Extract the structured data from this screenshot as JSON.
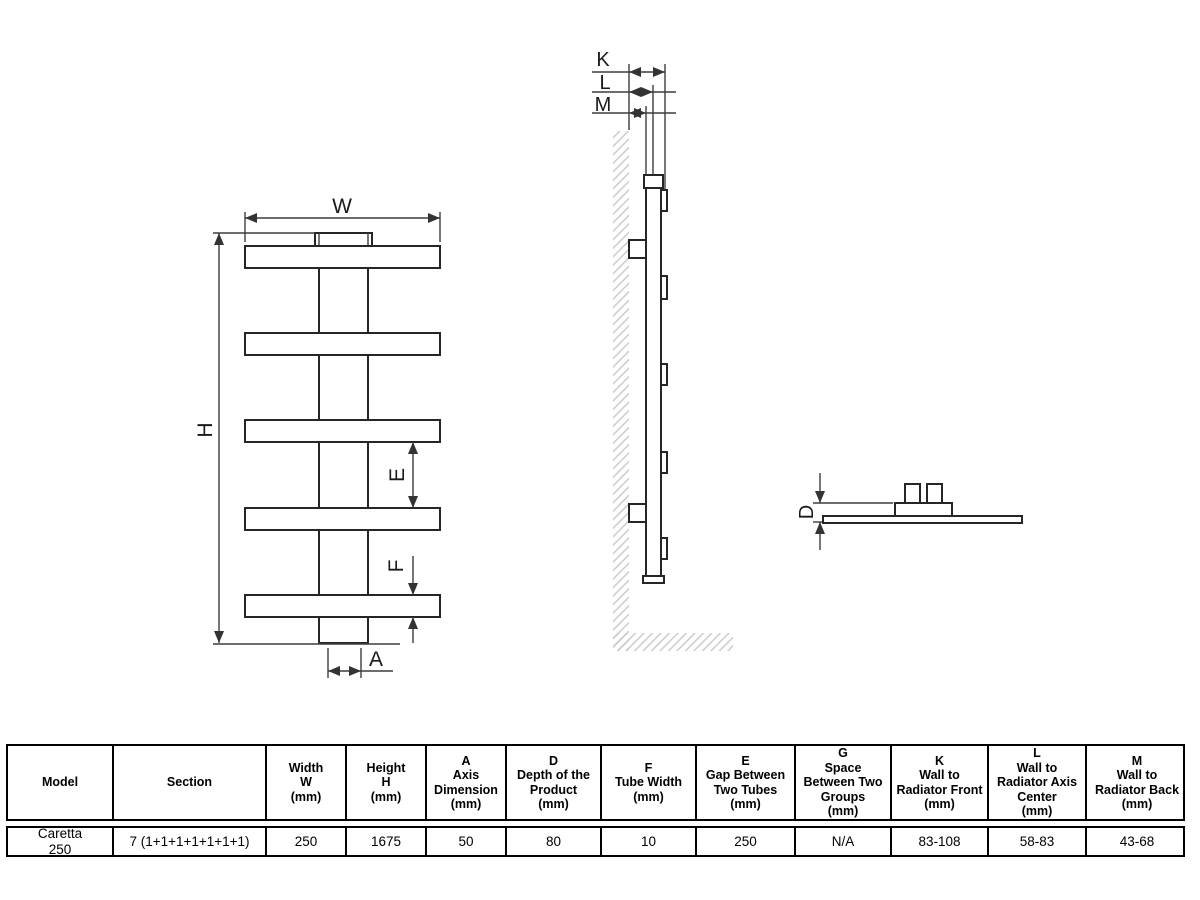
{
  "title": "Caretta 250 towel radiator dimension drawing",
  "colors": {
    "line": "#262626",
    "dimension_line": "#3d3d3d",
    "hatch": "#c8c8c8",
    "background": "#ffffff"
  },
  "dimensions": {
    "W": "W",
    "H": "H",
    "E": "E",
    "F": "F",
    "A": "A",
    "K": "K",
    "L": "L",
    "M": "M",
    "D": "D"
  },
  "table": {
    "headers": [
      "Model",
      "Section",
      "Width\nW\n(mm)",
      "Height\nH\n(mm)",
      "A\nAxis\nDimension\n(mm)",
      "D\nDepth of the\nProduct\n(mm)",
      "F\nTube Width\n(mm)",
      "E\nGap Between\nTwo Tubes\n(mm)",
      "G\nSpace\nBetween Two\nGroups\n(mm)",
      "K\nWall to\nRadiator Front\n(mm)",
      "L\nWall to\nRadiator Axis\nCenter\n(mm)",
      "M\nWall to\nRadiator Back\n(mm)"
    ],
    "row": [
      "Caretta\n250",
      "7 (1+1+1+1+1+1+1)",
      "250",
      "1675",
      "50",
      "80",
      "10",
      "250",
      "N/A",
      "83-108",
      "58-83",
      "43-68"
    ]
  }
}
